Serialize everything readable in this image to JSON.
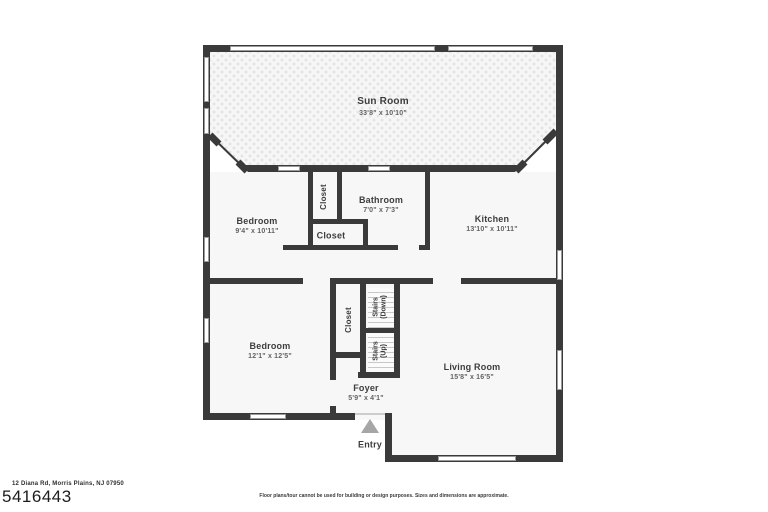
{
  "floorplan": {
    "sunroom": {
      "name": "Sun Room",
      "dims": "33'8\" x 10'10\""
    },
    "bedroom1": {
      "name": "Bedroom",
      "dims": "9'4\" x 10'11\""
    },
    "closet1": {
      "name": "Closet"
    },
    "bathroom": {
      "name": "Bathroom",
      "dims": "7'0\" x 7'3\""
    },
    "closet2": {
      "name": "Closet"
    },
    "kitchen": {
      "name": "Kitchen",
      "dims": "13'10\" x 10'11\""
    },
    "bedroom2": {
      "name": "Bedroom",
      "dims": "12'1\" x 12'5\""
    },
    "closet3": {
      "name": "Closet"
    },
    "stairs_down": {
      "name": "Stairs",
      "sub": "(Down)"
    },
    "stairs_up": {
      "name": "Stairs",
      "sub": "(Up)"
    },
    "foyer": {
      "name": "Foyer",
      "dims": "5'9\" x 4'1\""
    },
    "living_room": {
      "name": "Living Room",
      "dims": "15'8\" x 16'5\""
    },
    "entry": {
      "label": "Entry"
    }
  },
  "footer": {
    "address": "12 Diana Rd, Morris Plains, NJ 07950",
    "listing_number": "5416443",
    "disclaimer": "Floor plans/tour cannot be used for building or design purposes. Sizes and dimensions are approximate."
  },
  "colors": {
    "wall": "#3a3a3a",
    "room_fill": "#f7f7f7",
    "entry_arrow": "#a6a6a6"
  }
}
